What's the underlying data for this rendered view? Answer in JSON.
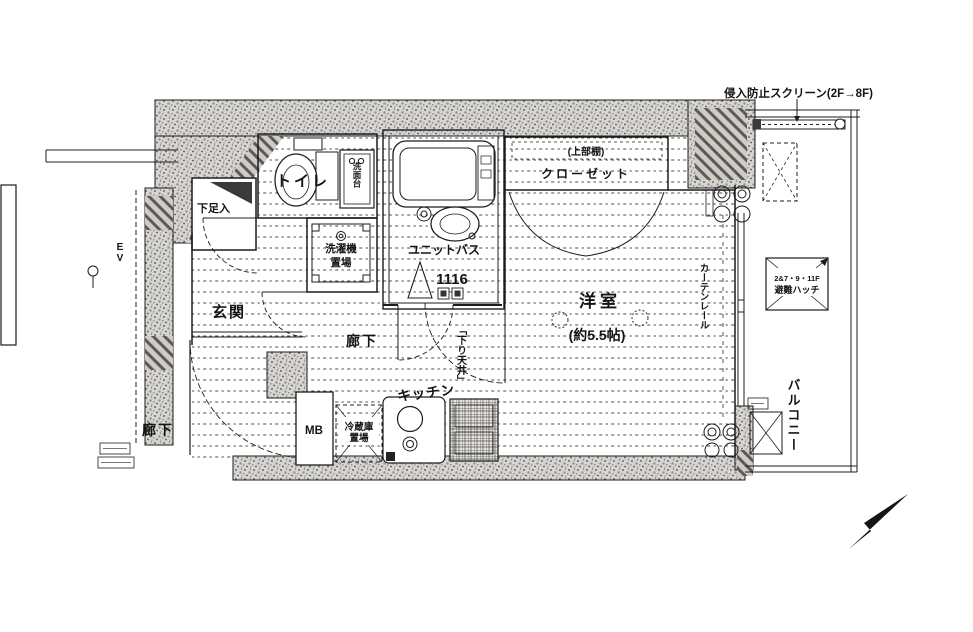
{
  "plan": {
    "annotations": {
      "intrusion_screen": "侵入防止スクリーン(2F→8F)",
      "lowered_ceiling": "「下り天井」",
      "curtain_rail": "カーテンレール",
      "hatch_floors": "2&7・9・11F",
      "hatch": "避難ハッチ"
    },
    "rooms": {
      "toilet": "トイレ",
      "washer_line1": "洗濯機",
      "washer_line2": "置場",
      "unit_bath": "ユニットバス",
      "unit_bath_size": "1116",
      "closet_upper_shelf": "(上部棚)",
      "closet": "クローゼット",
      "western_room": "洋室",
      "western_room_size": "(約5.5帖)",
      "entrance": "玄関",
      "hall_inner": "廊下",
      "hall_outer": "廊下",
      "kitchen": "キッチン",
      "fridge_line1": "冷蔵庫",
      "fridge_line2": "置場",
      "vanity": "洗面台",
      "meter_box": "MB",
      "shoe_cabinet": "下足入",
      "elevator": "EV",
      "balcony": "バルコニー"
    },
    "colors": {
      "wall_fill": "#d7d5d1",
      "line": "#1c1c1c",
      "background": "#ffffff"
    }
  }
}
